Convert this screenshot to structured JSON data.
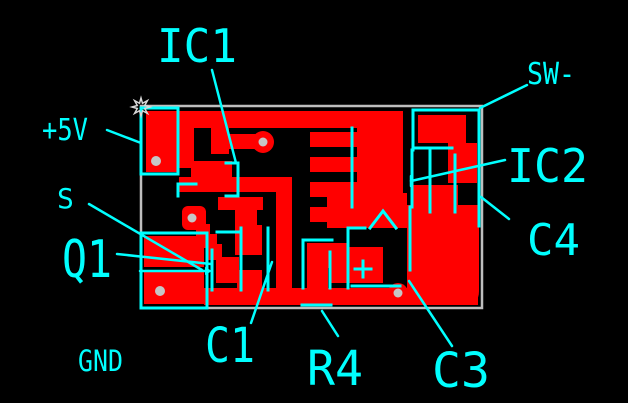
{
  "colors": {
    "background": "#000000",
    "copper": "#FF0000",
    "silkscreen": "#00FFFF",
    "board_outline": "#BEBEBE",
    "hole": "#C6C6C6",
    "cursor": "#D8D8D8"
  },
  "labels": {
    "plus5v": "+5V",
    "s": "S",
    "q1": "Q1",
    "gnd": "GND",
    "ic1": "IC1",
    "sw_minus": "SW-",
    "ic2": "IC2",
    "c4": "C4",
    "c1": "C1",
    "r4": "R4",
    "c3": "C3",
    "polarity_plus": "+"
  },
  "icons": {
    "cursor": "starburst-cursor"
  }
}
